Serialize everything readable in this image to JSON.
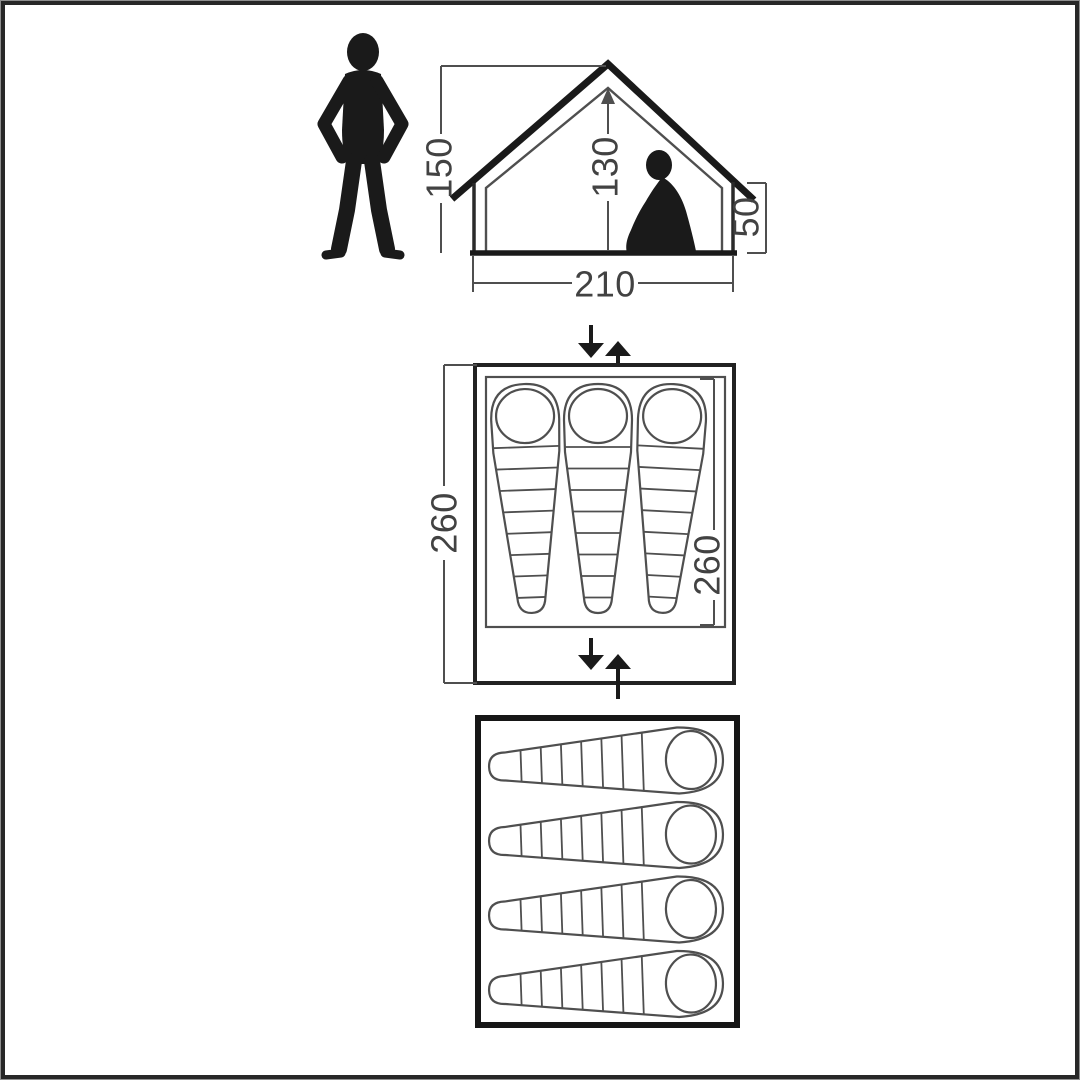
{
  "side_view": {
    "ridge_height_label": "150",
    "inner_height_label": "130",
    "side_wall_height_label": "50",
    "floor_width_label": "210",
    "figures": [
      "standing-person",
      "sitting-person"
    ]
  },
  "floor_plan_top": {
    "outer_length_label": "260",
    "inner_length_label": "260",
    "sleeping_bag_count": 3,
    "entrance_arrows": [
      "top",
      "bottom"
    ]
  },
  "floor_plan_bottom": {
    "sleeping_bag_count": 4
  },
  "icons": {
    "standing-person-icon": "black human silhouette, hands on hips",
    "sitting-person-icon": "black human silhouette sitting with knees up",
    "entrance-arrow-down-icon": "solid black down arrow",
    "entrance-arrow-up-icon": "solid black up arrow"
  },
  "colors": {
    "background": "#ffffff",
    "frame_border": "#272727",
    "line_thick": "#1a1a1a",
    "line_thin": "#4f4f4f",
    "text": "#424242"
  }
}
